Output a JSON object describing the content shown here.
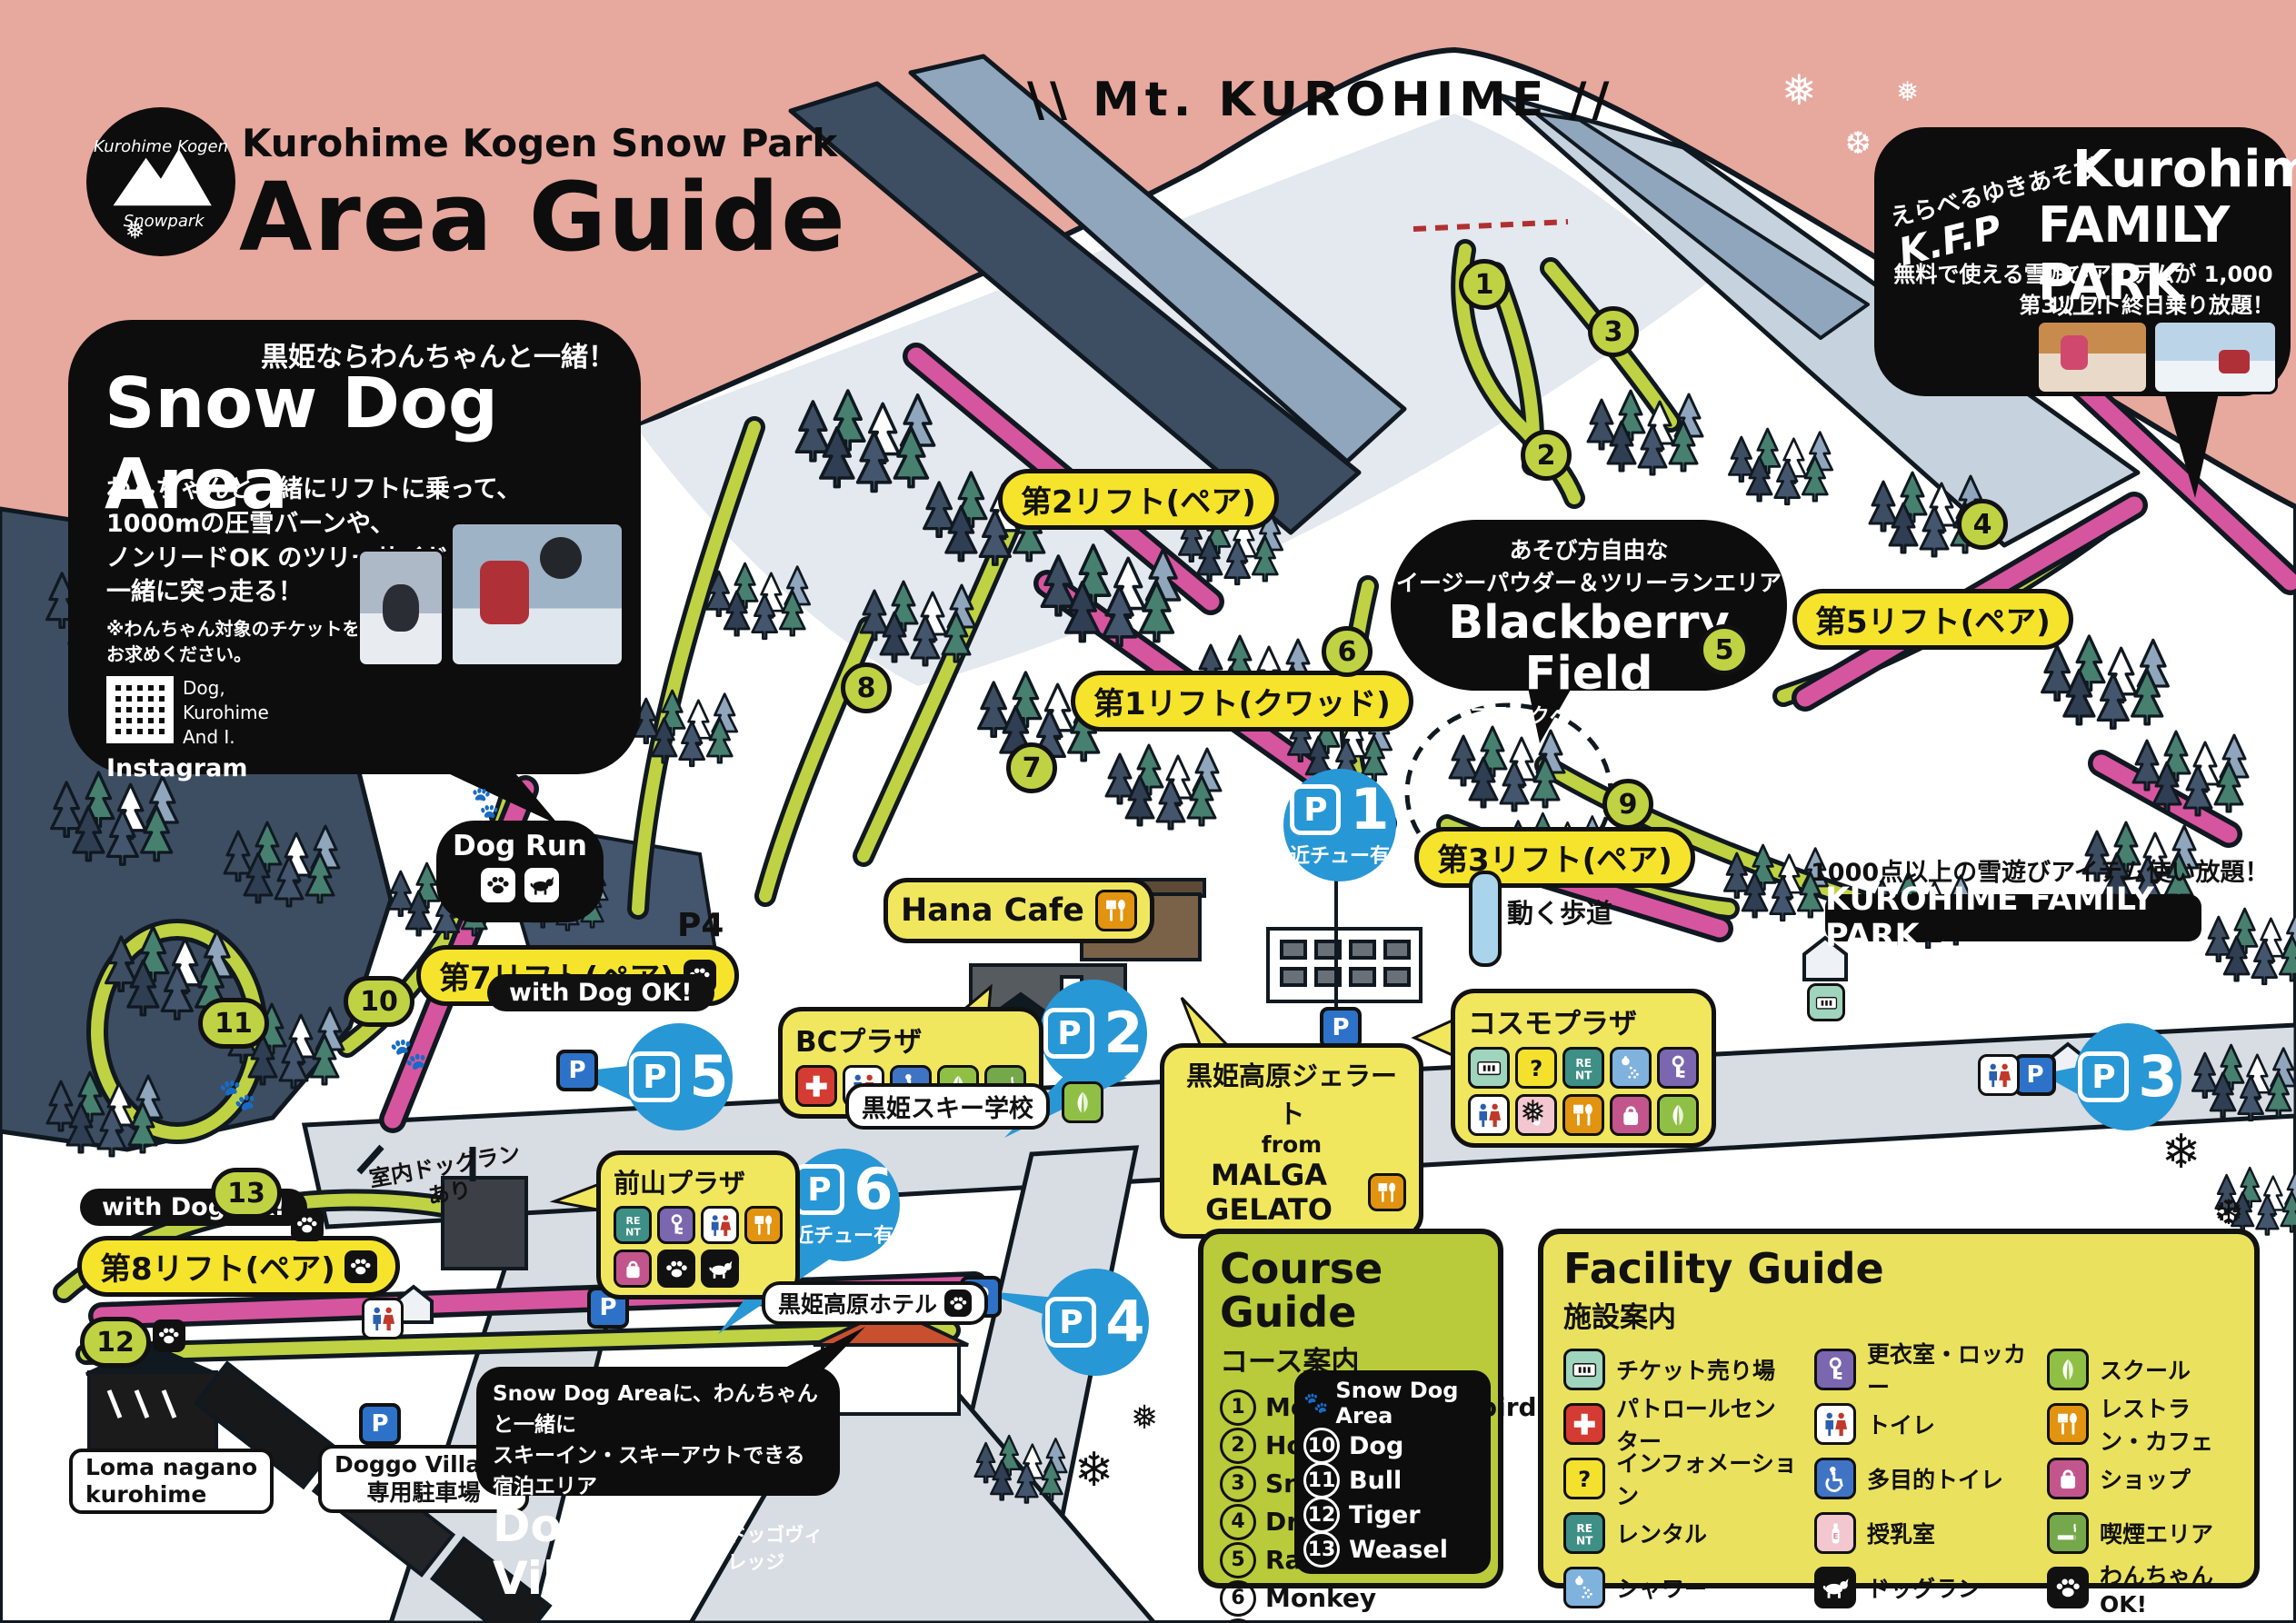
{
  "header": {
    "brand": "Kurohime Kogen Snow Park",
    "title": "Area Guide",
    "logo_script_line1": "Kurohime Kogen",
    "logo_script_line2": "Snowpark"
  },
  "mountain": {
    "marks_left": "\\\\",
    "title": "Mt. KUROHIME",
    "marks_right": "//"
  },
  "snow_dog": {
    "tagline": "黒姫ならわんちゃんと一緒！",
    "title": "Snow Dog Area",
    "body_line1": "わんちゃんと一緒にリフトに乗って、",
    "body_line2": "1000mの圧雪バーンや、",
    "body_line3": "ノンリードOK のツリーサイドコースを",
    "body_line4": "一緒に突っ走る！",
    "note_line1": "※わんちゃん対象のチケットを",
    "note_line2": "お求めください。",
    "qr_caption_line1": "Dog,",
    "qr_caption_line2": "Kurohime",
    "qr_caption_line3": "And I.",
    "instagram": "Instagram"
  },
  "family_bubble": {
    "slogan": "えらべるゆきあそび",
    "kfp": "K.F.P",
    "title1": "Kurohime",
    "title2": "FAMILY PARK",
    "line1": "無料で使える雪遊びアイテムが 1,000 以上！",
    "line2": "第3リフト終日乗り放題！"
  },
  "blackberry": {
    "line1": "あそび方自由な",
    "line2": "イージーパウダー＆ツリーランエリア",
    "title": "Blackberry Field",
    "subtitle": "ブラックベリーフィールド"
  },
  "lifts": {
    "lift1": "第1リフト(クワッド)",
    "lift2": "第2リフト(ペア)",
    "lift3": "第3リフト(ペア)",
    "lift5": "第5リフト(ペア)",
    "lift7": "第7リフト(ペア)",
    "lift8": "第8リフト(ペア)"
  },
  "labels": {
    "with_dog_ok": "with Dog OK!",
    "dog_run": "Dog Run",
    "p4_road": "P4",
    "hana_cafe": "Hana Cafe",
    "bc_plaza": "BCプラザ",
    "ski_school": "黒姫スキー学校",
    "cosmo_plaza": "コスモプラザ",
    "gelato_line1": "黒姫高原ジェラート",
    "gelato_line2": "from",
    "gelato_line3": "MALGA GELATO",
    "maeyama_plaza": "前山プラザ",
    "hotel": "黒姫高原ホテル",
    "moving_walkway": "動く歩道",
    "indoor_dogrun_line1": "室内ドッグラン",
    "indoor_dogrun_line2": "あり",
    "loma_line1": "Loma nagano",
    "loma_line2": "kurohime",
    "doggo_parking_line1": "Doggo Village",
    "doggo_parking_line2": "専用駐車場",
    "family_park_note": "1000点以上の雪遊びアイテム使い放題！",
    "family_park_label": "KUROHIME FAMILY PARK"
  },
  "doggo_village": {
    "line1": "Snow Dog Areaに、わんちゃんと一緒に",
    "line2": "スキーイン・スキーアウトできる宿泊エリア",
    "title": "Doggo Village",
    "subtitle": "ドッゴヴィレッジ"
  },
  "parking": {
    "symbol": "P",
    "p1": {
      "num": "1",
      "note": "近チュー有"
    },
    "p2": {
      "num": "2"
    },
    "p3": {
      "num": "3"
    },
    "p4": {
      "num": "4"
    },
    "p5": {
      "num": "5"
    },
    "p6": {
      "num": "6",
      "note": "近チュー有"
    }
  },
  "course_numbers": [
    "1",
    "2",
    "3",
    "4",
    "5",
    "6",
    "7",
    "8",
    "9",
    "10",
    "11",
    "12",
    "13"
  ],
  "course_guide": {
    "title": "Course Guide",
    "subtitle": "コース案内",
    "left": [
      {
        "num": "1",
        "name": "Mouse"
      },
      {
        "num": "2",
        "name": "Horse"
      },
      {
        "num": "3",
        "name": "Snake"
      },
      {
        "num": "4",
        "name": "Dragon"
      },
      {
        "num": "5",
        "name": "Rabbit"
      },
      {
        "num": "6",
        "name": "Monkey"
      },
      {
        "num": "7",
        "name": "Leo"
      }
    ],
    "right": [
      {
        "num": "8",
        "name": "Blackbird"
      },
      {
        "num": "9",
        "name": "Sheep"
      }
    ],
    "snow_dog": {
      "title": "Snow Dog Area",
      "items": [
        {
          "num": "10",
          "name": "Dog"
        },
        {
          "num": "11",
          "name": "Bull"
        },
        {
          "num": "12",
          "name": "Tiger"
        },
        {
          "num": "13",
          "name": "Weasel"
        }
      ]
    }
  },
  "facility_guide": {
    "title": "Facility Guide",
    "subtitle": "施設案内",
    "columns": [
      [
        {
          "icon": "ticket-icon",
          "label": "チケット売り場"
        },
        {
          "icon": "patrol-icon",
          "label": "パトロールセンター"
        },
        {
          "icon": "information-icon",
          "label": "インフォメーション"
        },
        {
          "icon": "rental-icon",
          "label": "レンタル"
        },
        {
          "icon": "shower-icon",
          "label": "シャワー"
        }
      ],
      [
        {
          "icon": "locker-icon",
          "label": "更衣室・ロッカー"
        },
        {
          "icon": "toilet-icon",
          "label": "トイレ"
        },
        {
          "icon": "accessible-toilet-icon",
          "label": "多目的トイレ"
        },
        {
          "icon": "nursing-room-icon",
          "label": "授乳室"
        },
        {
          "icon": "dog-run-icon",
          "label": "ドッグラン"
        }
      ],
      [
        {
          "icon": "school-icon",
          "label": "スクール"
        },
        {
          "icon": "restaurant-icon",
          "label": "レストラン・カフェ"
        },
        {
          "icon": "shop-icon",
          "label": "ショップ"
        },
        {
          "icon": "smoking-icon",
          "label": "喫煙エリア"
        },
        {
          "icon": "dog-ok-icon",
          "label": "わんちゃんOK!"
        }
      ]
    ]
  },
  "colors": {
    "sky_pink": "#e7a89e",
    "course_green": "#bfd243",
    "lift_pink": "#d6559f",
    "label_yellow": "#f6e42c",
    "parking_blue": "#2897d5",
    "panel_green": "#b9ca3a",
    "panel_yellow": "#eae25e"
  }
}
